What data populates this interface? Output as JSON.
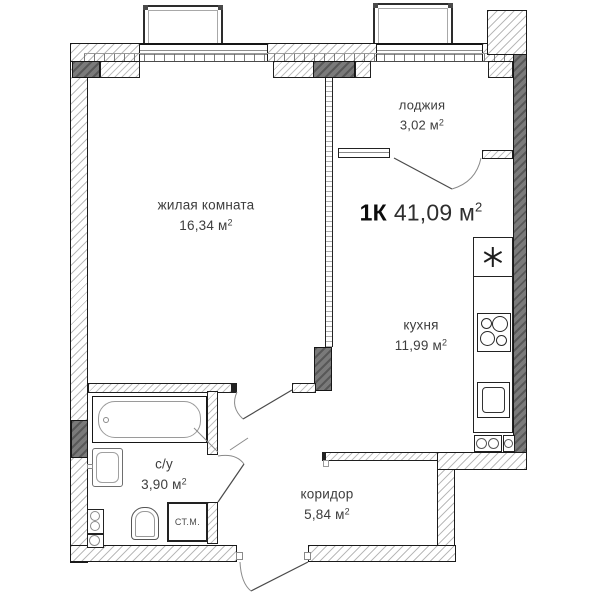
{
  "plan": {
    "unit": "м",
    "sup": "2",
    "title": {
      "type": "1К",
      "area": "41,09"
    },
    "rooms": [
      {
        "key": "living-room",
        "name": "жилая комната",
        "area": "16,34"
      },
      {
        "key": "loggia",
        "name": "лоджия",
        "area": "3,02"
      },
      {
        "key": "kitchen",
        "name": "кухня",
        "area": "11,99"
      },
      {
        "key": "bathroom",
        "name": "с/у",
        "area": "3,90"
      },
      {
        "key": "corridor",
        "name": "коридор",
        "area": "5,84"
      }
    ],
    "fixtures": {
      "washing_machine_label": "СТ.М."
    },
    "icons": {
      "fridge": "asterisk-snowflake"
    },
    "colors": {
      "wall_dark": "#7a7a7a",
      "outline": "#1a1a1a",
      "text": "#3d3d3d"
    }
  }
}
